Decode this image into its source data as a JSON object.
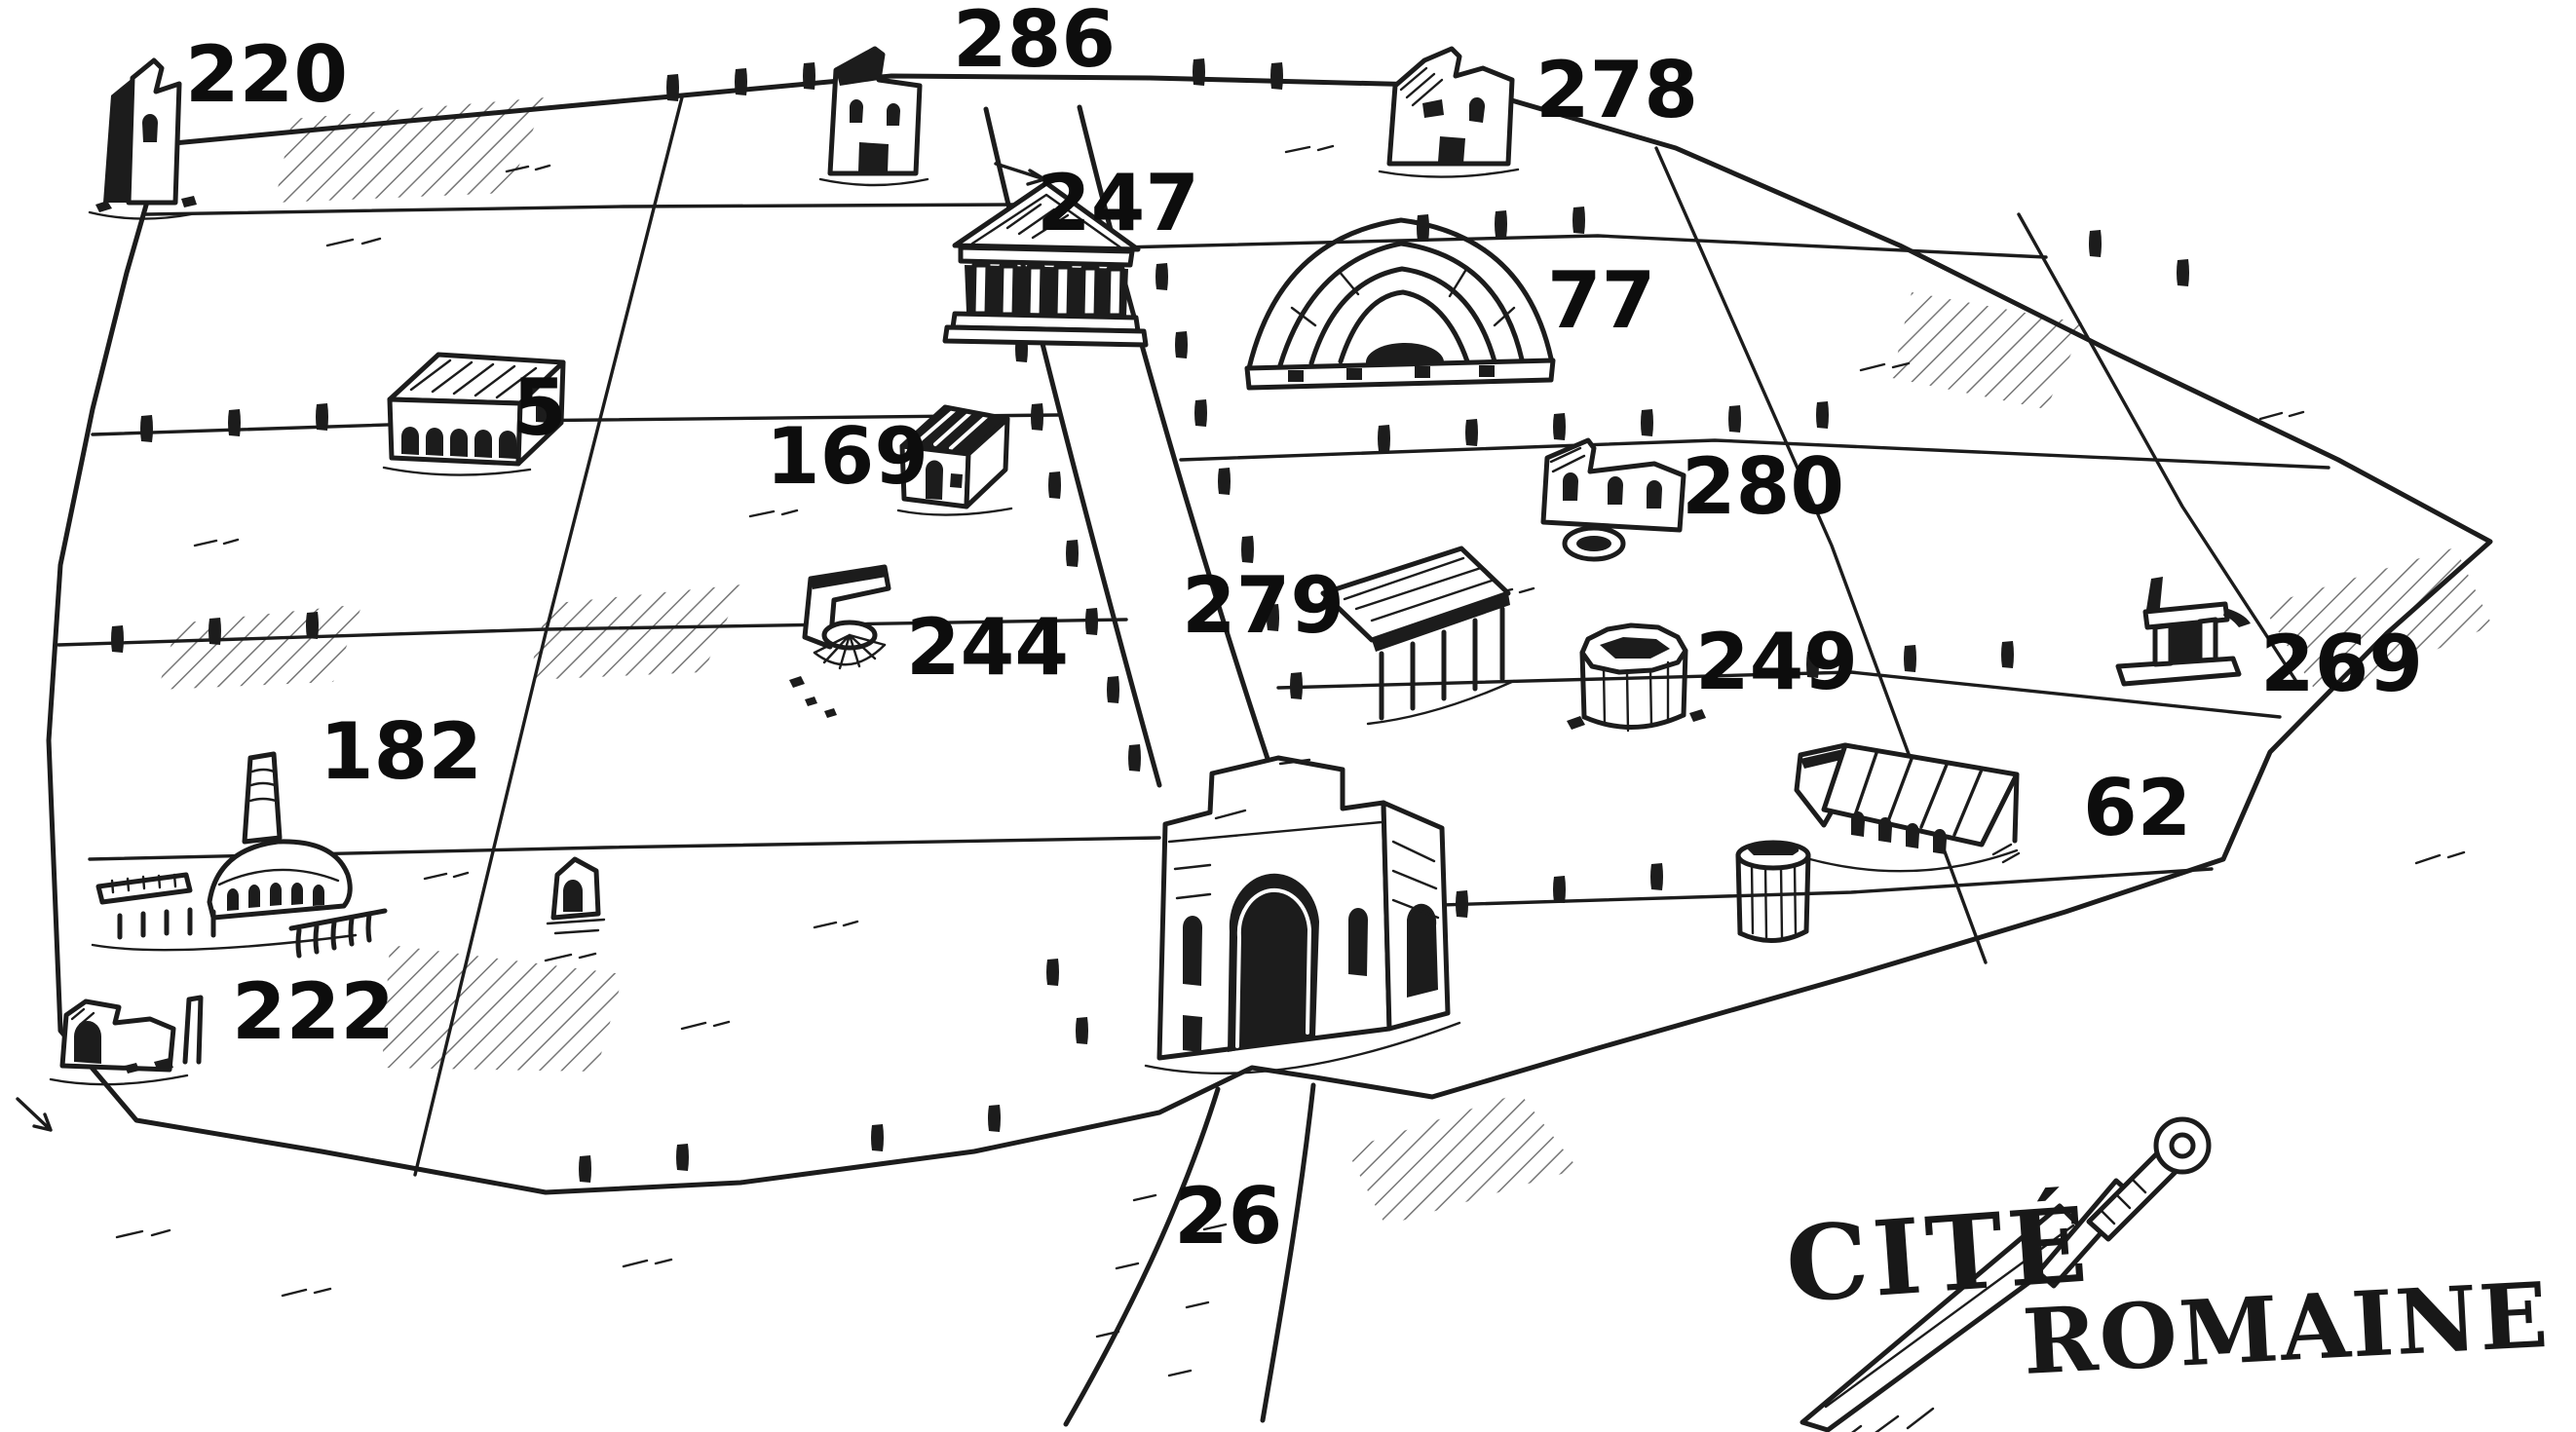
{
  "map": {
    "title": {
      "line1": "CITÉ",
      "line2": "ROMAINE"
    },
    "ink_color": "#1c1c1c",
    "paper_color": "#ffffff",
    "locations": [
      {
        "number": "220",
        "icon": "broken-tower-icon"
      },
      {
        "number": "286",
        "icon": "tall-ruin-icon"
      },
      {
        "number": "278",
        "icon": "gabled-ruin-icon"
      },
      {
        "number": "247",
        "icon": "temple-icon"
      },
      {
        "number": "77",
        "icon": "theater-icon"
      },
      {
        "number": "5",
        "icon": "arcaded-hall-icon"
      },
      {
        "number": "169",
        "icon": "small-house-icon"
      },
      {
        "number": "280",
        "icon": "niche-ruin-icon"
      },
      {
        "number": "279",
        "icon": "portico-ruin-icon"
      },
      {
        "number": "244",
        "icon": "collapsed-wall-icon"
      },
      {
        "number": "249",
        "icon": "round-tower-icon"
      },
      {
        "number": "269",
        "icon": "column-ruin-icon"
      },
      {
        "number": "182",
        "icon": "baths-furnace-icon"
      },
      {
        "number": "62",
        "icon": "long-hall-icon"
      },
      {
        "number": "222",
        "icon": "arch-grotto-icon"
      },
      {
        "number": "26",
        "icon": "city-gate-icon"
      }
    ]
  }
}
